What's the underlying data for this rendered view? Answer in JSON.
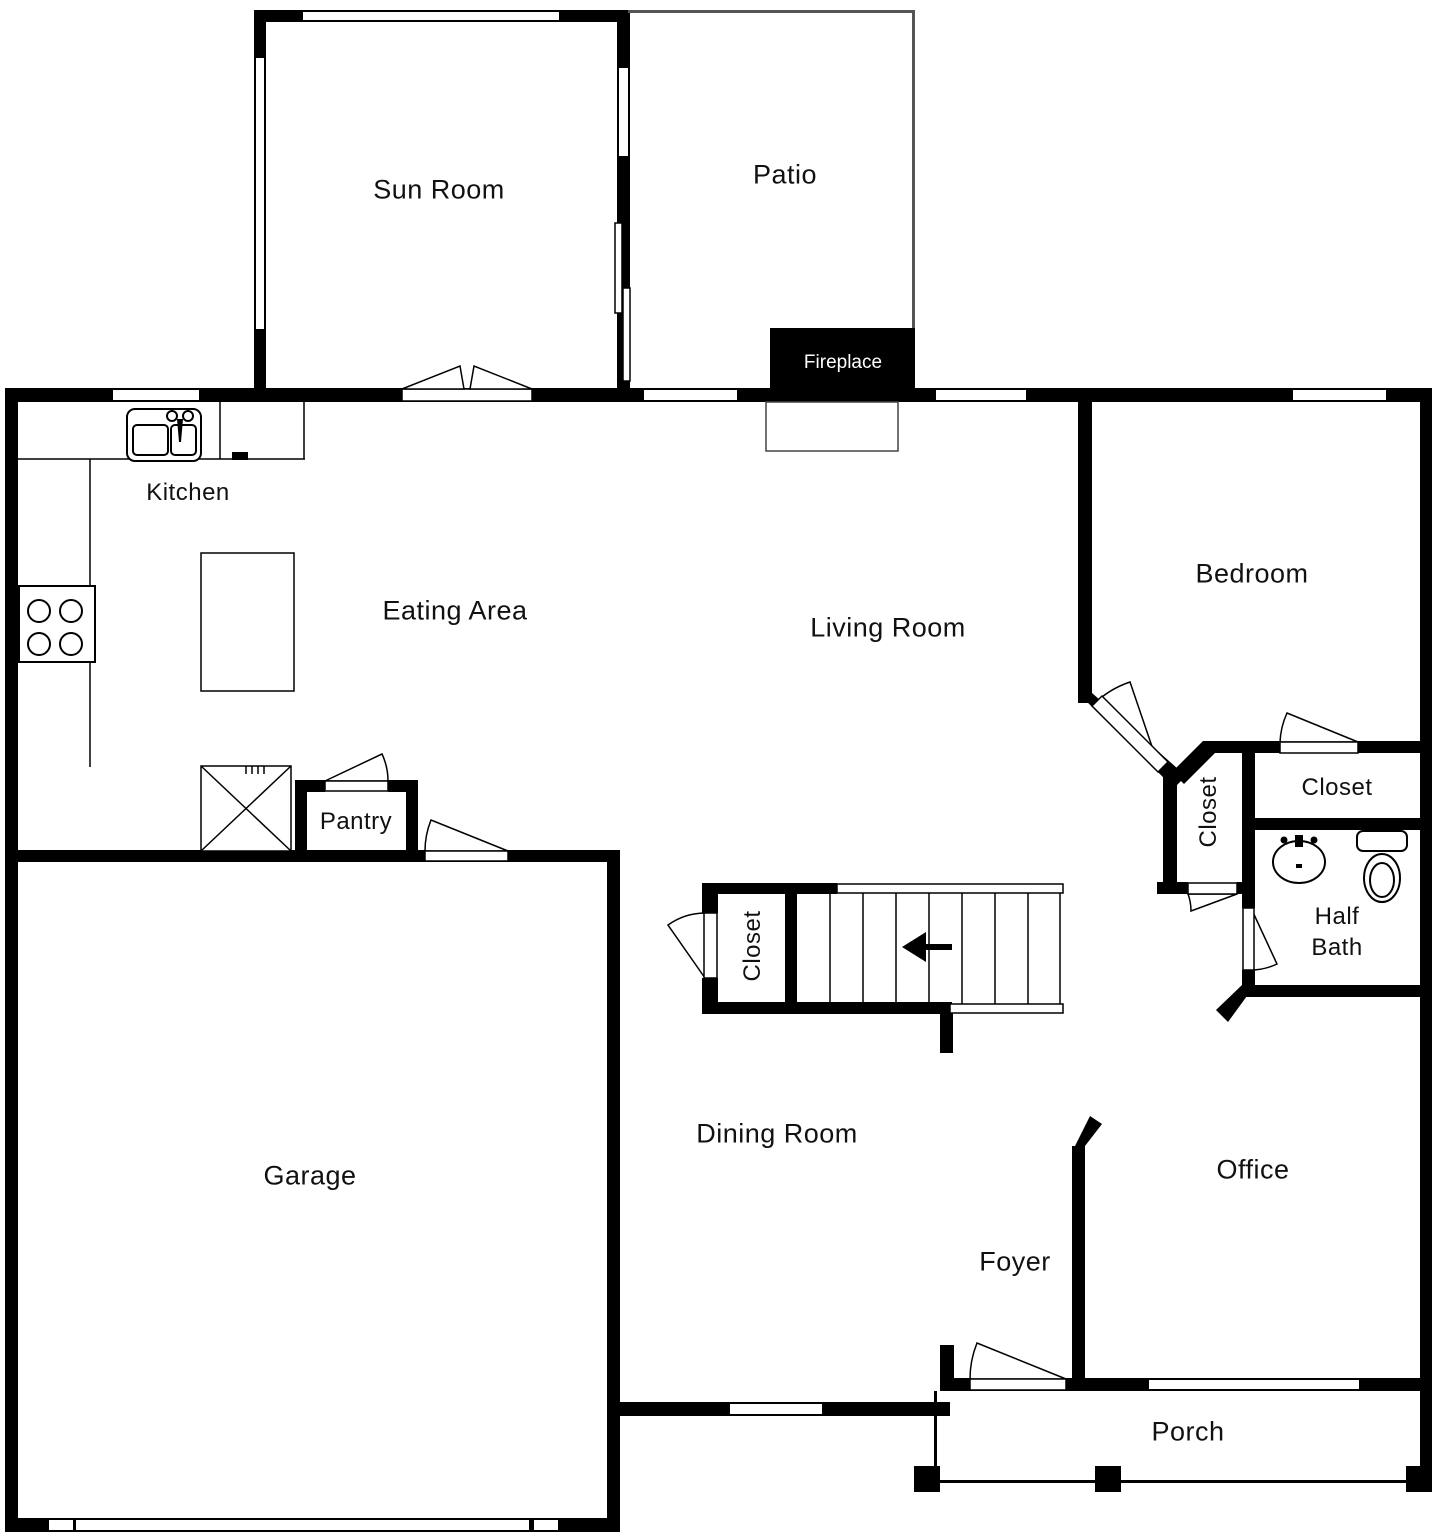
{
  "rooms": {
    "sun_room": {
      "label": "Sun Room"
    },
    "patio": {
      "label": "Patio"
    },
    "kitchen": {
      "label": "Kitchen"
    },
    "eating_area": {
      "label": "Eating Area"
    },
    "living_room": {
      "label": "Living Room"
    },
    "bedroom": {
      "label": "Bedroom"
    },
    "hall_closet": {
      "label": "Closet"
    },
    "bedroom_closet": {
      "label": "Closet"
    },
    "half_bath": {
      "label": "Half Bath"
    },
    "stair_closet": {
      "label": "Closet"
    },
    "pantry": {
      "label": "Pantry"
    },
    "garage": {
      "label": "Garage"
    },
    "dining_room": {
      "label": "Dining Room"
    },
    "office": {
      "label": "Office"
    },
    "foyer": {
      "label": "Foyer"
    },
    "porch": {
      "label": "Porch"
    }
  },
  "fixtures": {
    "fireplace_label": "Fireplace"
  },
  "colors": {
    "wall": "#000000",
    "background": "#ffffff",
    "fireplace_text": "#ffffff"
  }
}
